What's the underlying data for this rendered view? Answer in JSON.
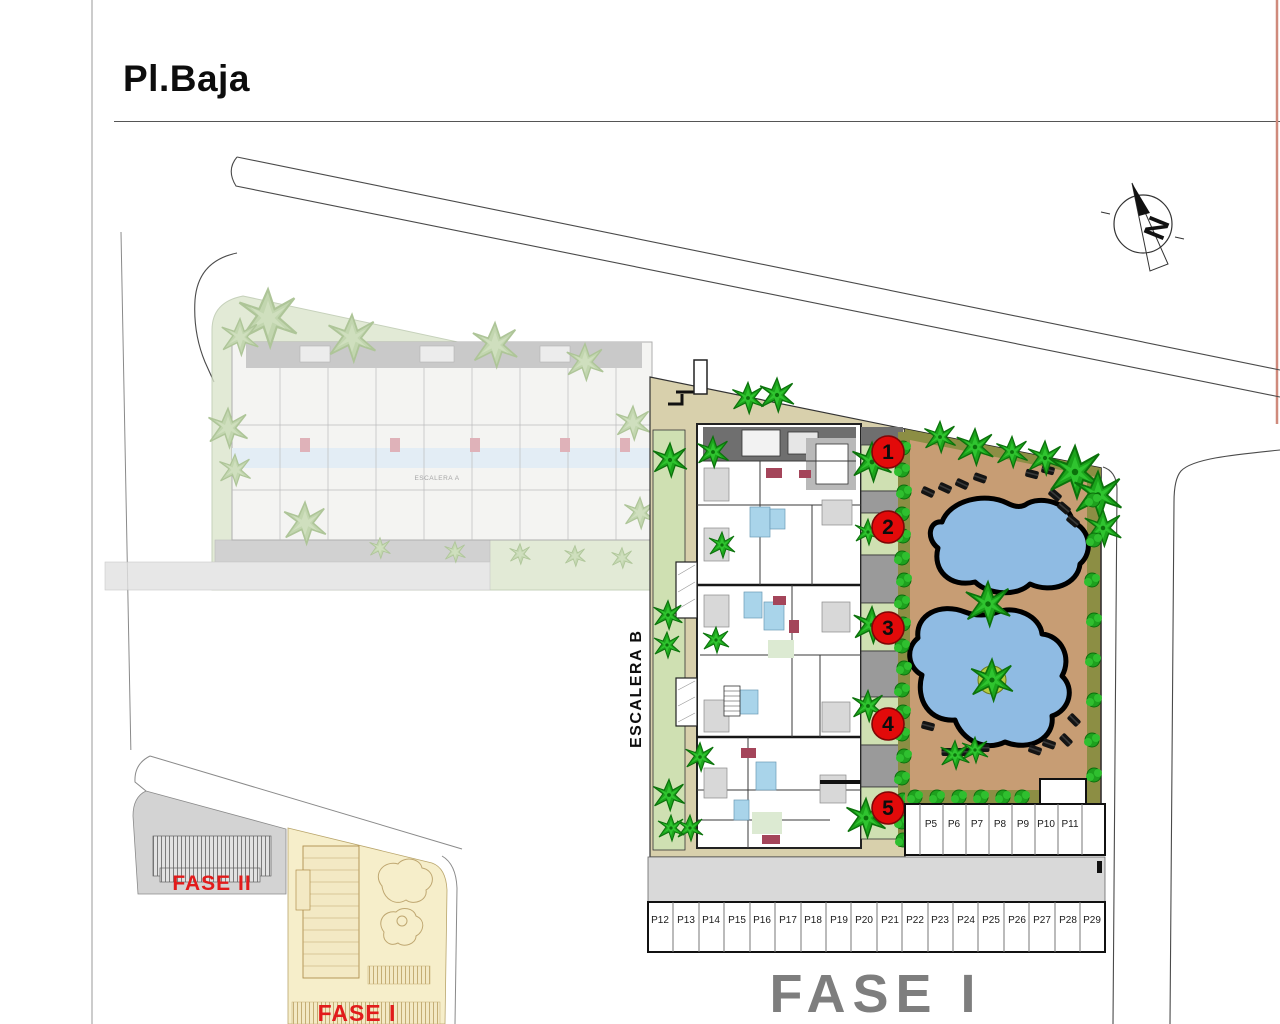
{
  "title": "Pl.Baja",
  "north": {
    "letter": "N"
  },
  "escalera_b": "ESCALERA B",
  "escalera_a": "ESCALERA A",
  "phase_big_label": "FASE I",
  "inset": {
    "fase2": "FASE II",
    "fase1": "FASE I"
  },
  "units": [
    "1",
    "2",
    "3",
    "4",
    "5"
  ],
  "parking": {
    "upper": [
      "P5",
      "P6",
      "P7",
      "P8",
      "P9",
      "P10",
      "P11"
    ],
    "lower": [
      "P12",
      "P13",
      "P14",
      "P15",
      "P16",
      "P17",
      "P18",
      "P19",
      "P20",
      "P21",
      "P22",
      "P23",
      "P24",
      "P25",
      "P26",
      "P27",
      "P28",
      "P29"
    ]
  },
  "colors": {
    "pool": "#8fbbe3",
    "deck_tan": "#c79d74",
    "path_khaki": "#d8d0ac",
    "lawn_green": "#cfe0b2",
    "hedge_olive": "#8c8e44",
    "tree_green": "#1ca51c",
    "unit_red": "#e20a0a",
    "phase_text_red": "#e21b1b",
    "phase_big_gray": "#7e7e7e",
    "fase2_gray": "#d3d3d3",
    "fase1_cream": "#f6eeca"
  }
}
